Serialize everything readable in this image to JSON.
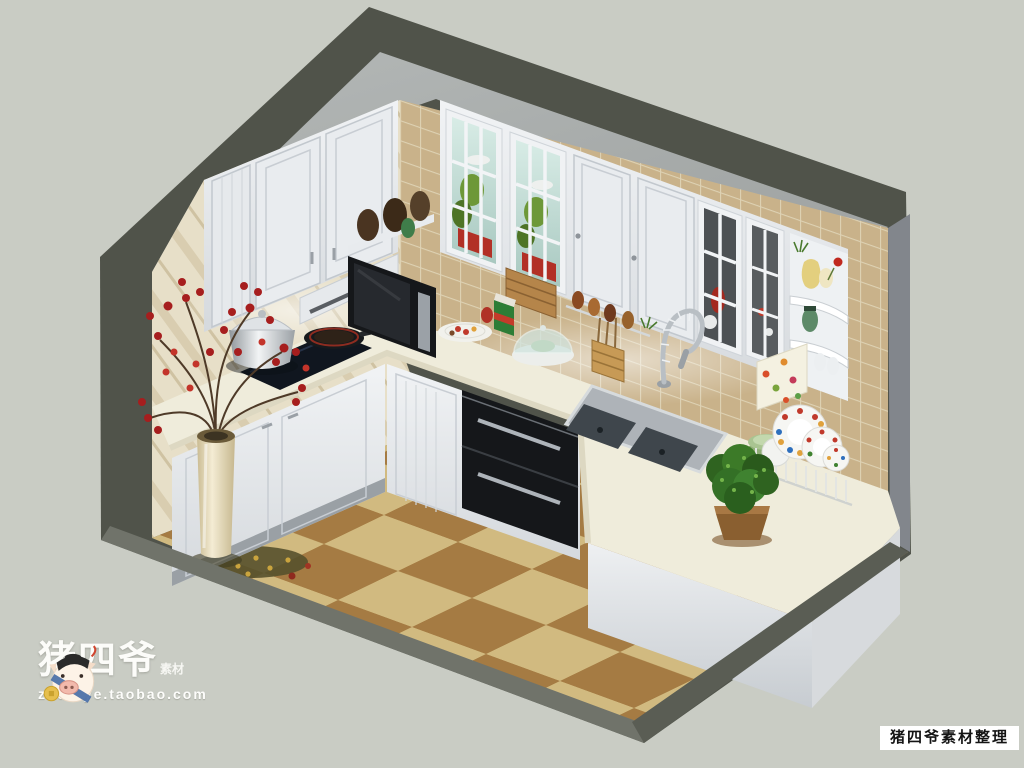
{
  "watermarks": {
    "brand": "猪四爷",
    "brand_suffix": "素材",
    "brand_url": "zhusiye.taobao.com",
    "credit": "猪四爷素材整理"
  },
  "palette": {
    "bg": "#c9ccc4",
    "shell": "#50534a",
    "top_face": "#a9adad",
    "wall_beige": "#e7dfc8",
    "tile": "#c9b28a",
    "grout": "#ded2b4",
    "cabinet": "#eef0f3",
    "cabinet_shade": "#d7dbdf",
    "counter": "#efecdb",
    "appliance": "#15171a",
    "floor_dark": "#9b6d2e",
    "floor_light": "#ccb372",
    "plant": "#3f7a28",
    "berry": "#a61e1e",
    "steel": "#c9ced2",
    "shelf_white": "#eef1f3"
  },
  "scene": {
    "view": "isometric-cutaway-kitchen-render",
    "objects": [
      "upper-cabinets",
      "glass-display-cabinets",
      "corner-display-shelf",
      "range-hood",
      "microwave-oven",
      "built-in-oven-drawers",
      "induction-cooktop",
      "stock-pot",
      "frying-pan",
      "double-bowl-sink",
      "gooseneck-faucet",
      "l-shaped-countertop",
      "peninsula-counter",
      "potted-plant",
      "dish-rack-with-plates",
      "green-bowls",
      "floor-vase-with-red-branches",
      "tiled-backsplash",
      "checkered-tile-floor",
      "wooden-knife-block",
      "spice-rack",
      "floral-towel",
      "food-plate",
      "juice-carton",
      "cake-dome",
      "utensil-caddy"
    ]
  }
}
